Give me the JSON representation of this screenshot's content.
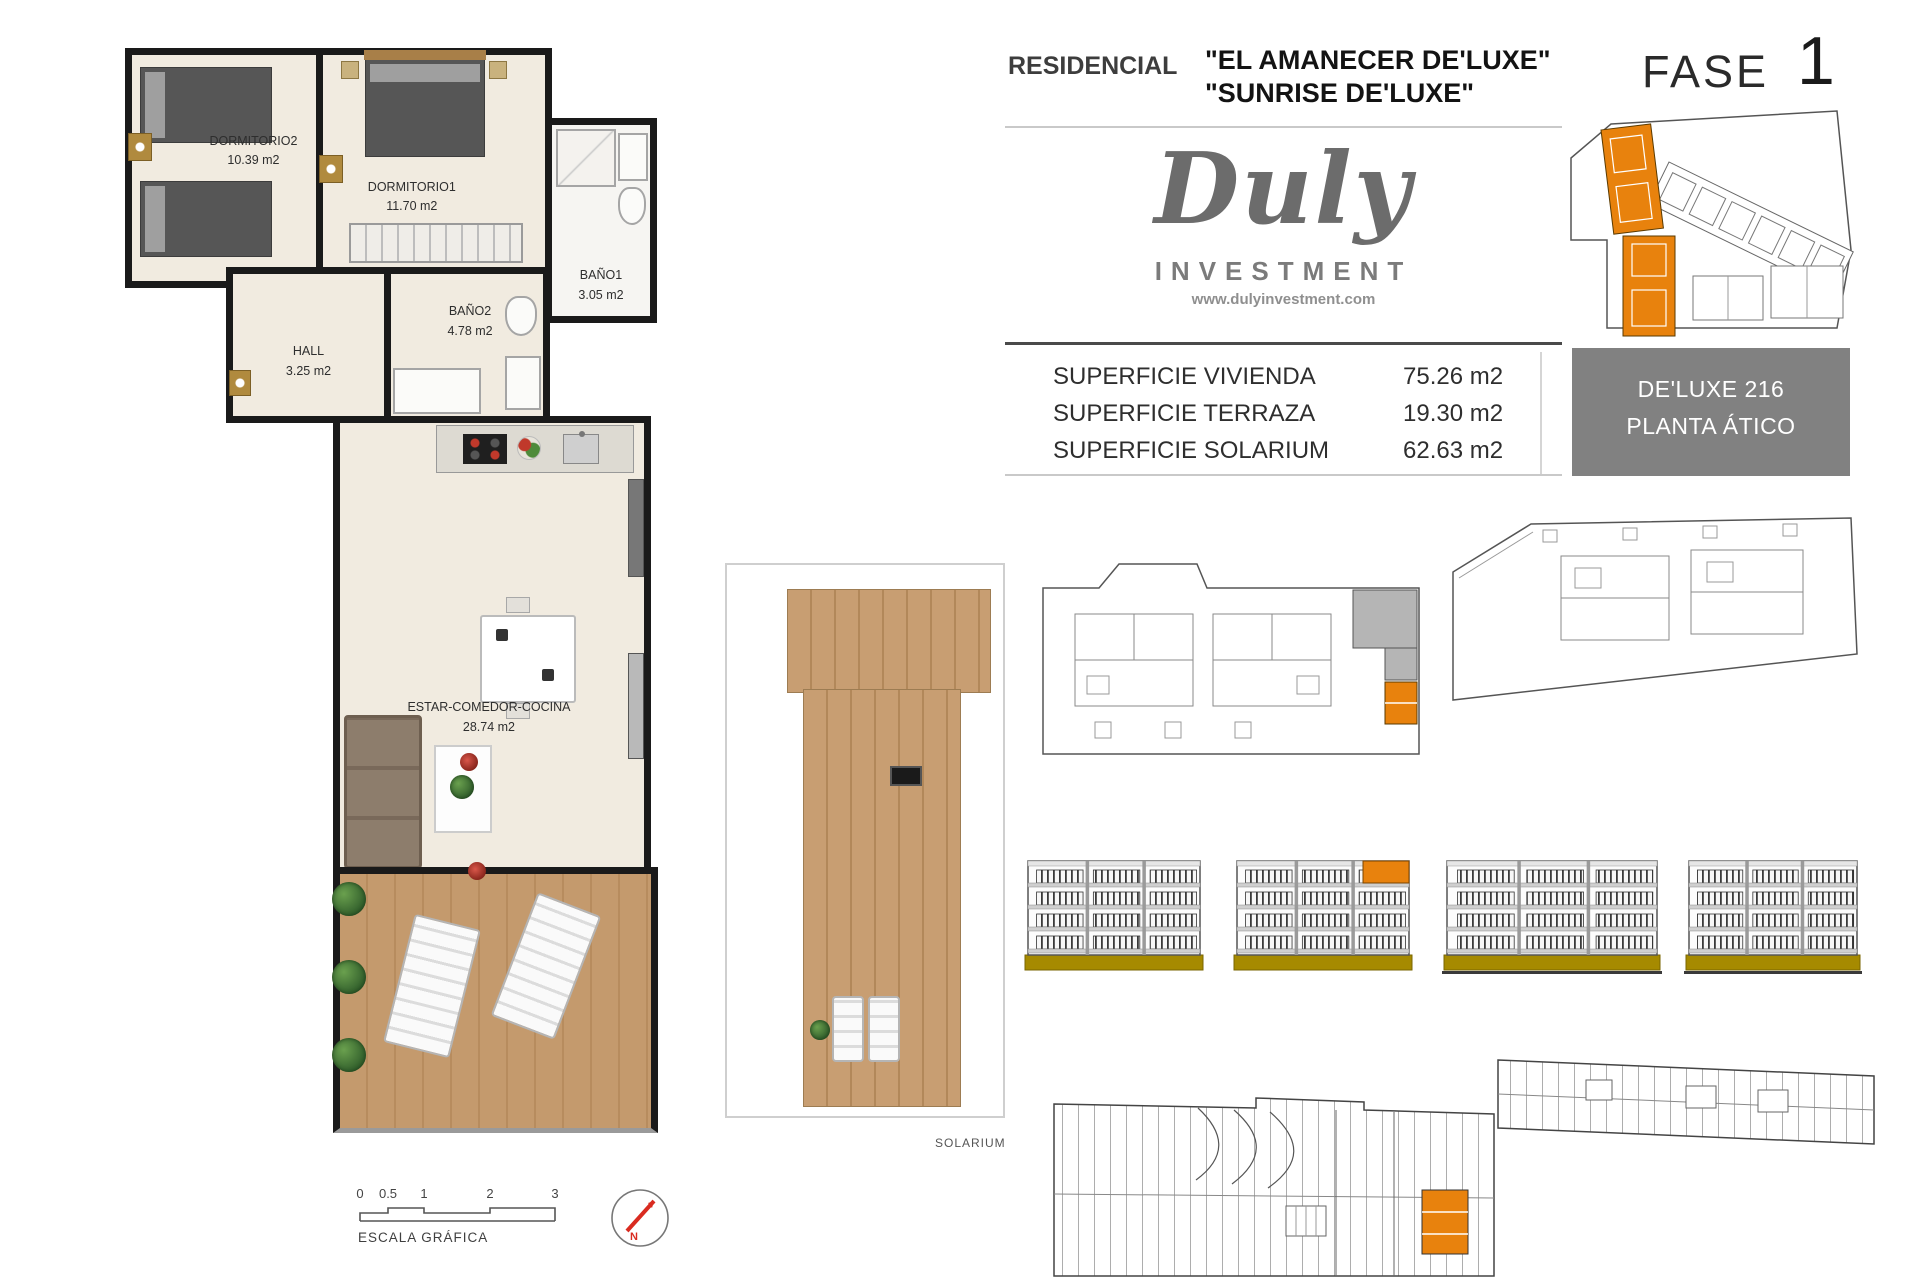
{
  "colors": {
    "accent_orange": "#E8820D",
    "olive_base": "#A68A00",
    "unit_box_bg": "#818181",
    "logo_gray": "#6C6C6C",
    "wall_black": "#1A1A1A",
    "floor_cream": "#F1EBE0",
    "wood_deck": "#C49A6D",
    "compass_red": "#D92B20"
  },
  "header": {
    "residencial_label": "RESIDENCIAL",
    "name_line1": "\"EL AMANECER DE'LUXE\"",
    "name_line2": "\"SUNRISE DE'LUXE\"",
    "fase_label": "FASE",
    "fase_number": "1"
  },
  "logo": {
    "brand": "Duly",
    "subtitle": "INVESTMENT",
    "website": "www.dulyinvestment.com"
  },
  "surface_table": {
    "rows": [
      {
        "label": "SUPERFICIE VIVIENDA",
        "value": "75.26 m2"
      },
      {
        "label": "SUPERFICIE TERRAZA",
        "value": "19.30 m2"
      },
      {
        "label": "SUPERFICIE SOLARIUM",
        "value": "62.63 m2"
      }
    ]
  },
  "unit_box": {
    "line1": "DE'LUXE 216",
    "line2": "PLANTA ÁTICO"
  },
  "floor_plan": {
    "rooms": [
      {
        "name": "DORMITORIO2",
        "area": "10.39 m2"
      },
      {
        "name": "DORMITORIO1",
        "area": "11.70 m2"
      },
      {
        "name": "BAÑO1",
        "area": "3.05 m2"
      },
      {
        "name": "BAÑO2",
        "area": "4.78 m2"
      },
      {
        "name": "HALL",
        "area": "3.25 m2"
      },
      {
        "name": "ESTAR-COMEDOR-COCINA",
        "area": "28.74 m2"
      }
    ]
  },
  "solarium_label": "SOLARIUM",
  "scale_bar": {
    "ticks": [
      "0",
      "0.5",
      "1",
      "2",
      "3"
    ],
    "label": "ESCALA GRÁFICA"
  },
  "compass": {
    "north_label": "N"
  }
}
